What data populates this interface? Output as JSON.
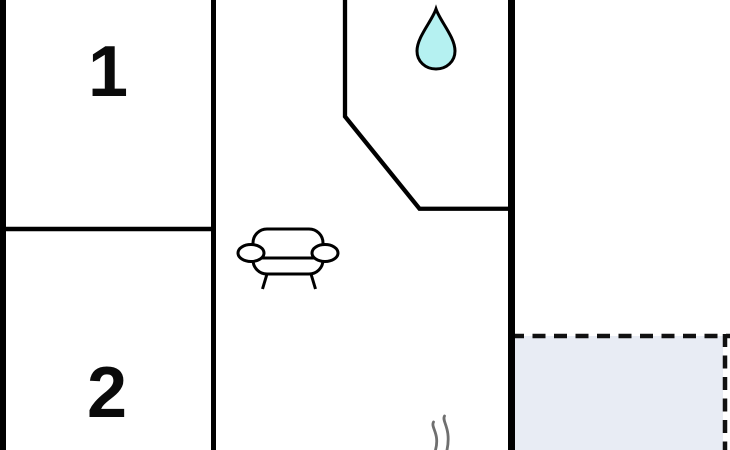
{
  "floorplan": {
    "rooms": {
      "room1_label": "1",
      "room2_label": "2"
    },
    "icons": [
      {
        "name": "water-drop-icon"
      },
      {
        "name": "sofa-icon"
      },
      {
        "name": "steam-icon"
      }
    ]
  },
  "palette": {
    "wall": "#000000",
    "label_color": "#0a0a0a",
    "water_drop_fill": "#b5f1f1",
    "water_drop_outline": "#000000",
    "terrace_fill": "#e8ecf4",
    "terrace_border": "#111111",
    "steam_stroke": "#6f6f6f",
    "background": "#ffffff"
  }
}
